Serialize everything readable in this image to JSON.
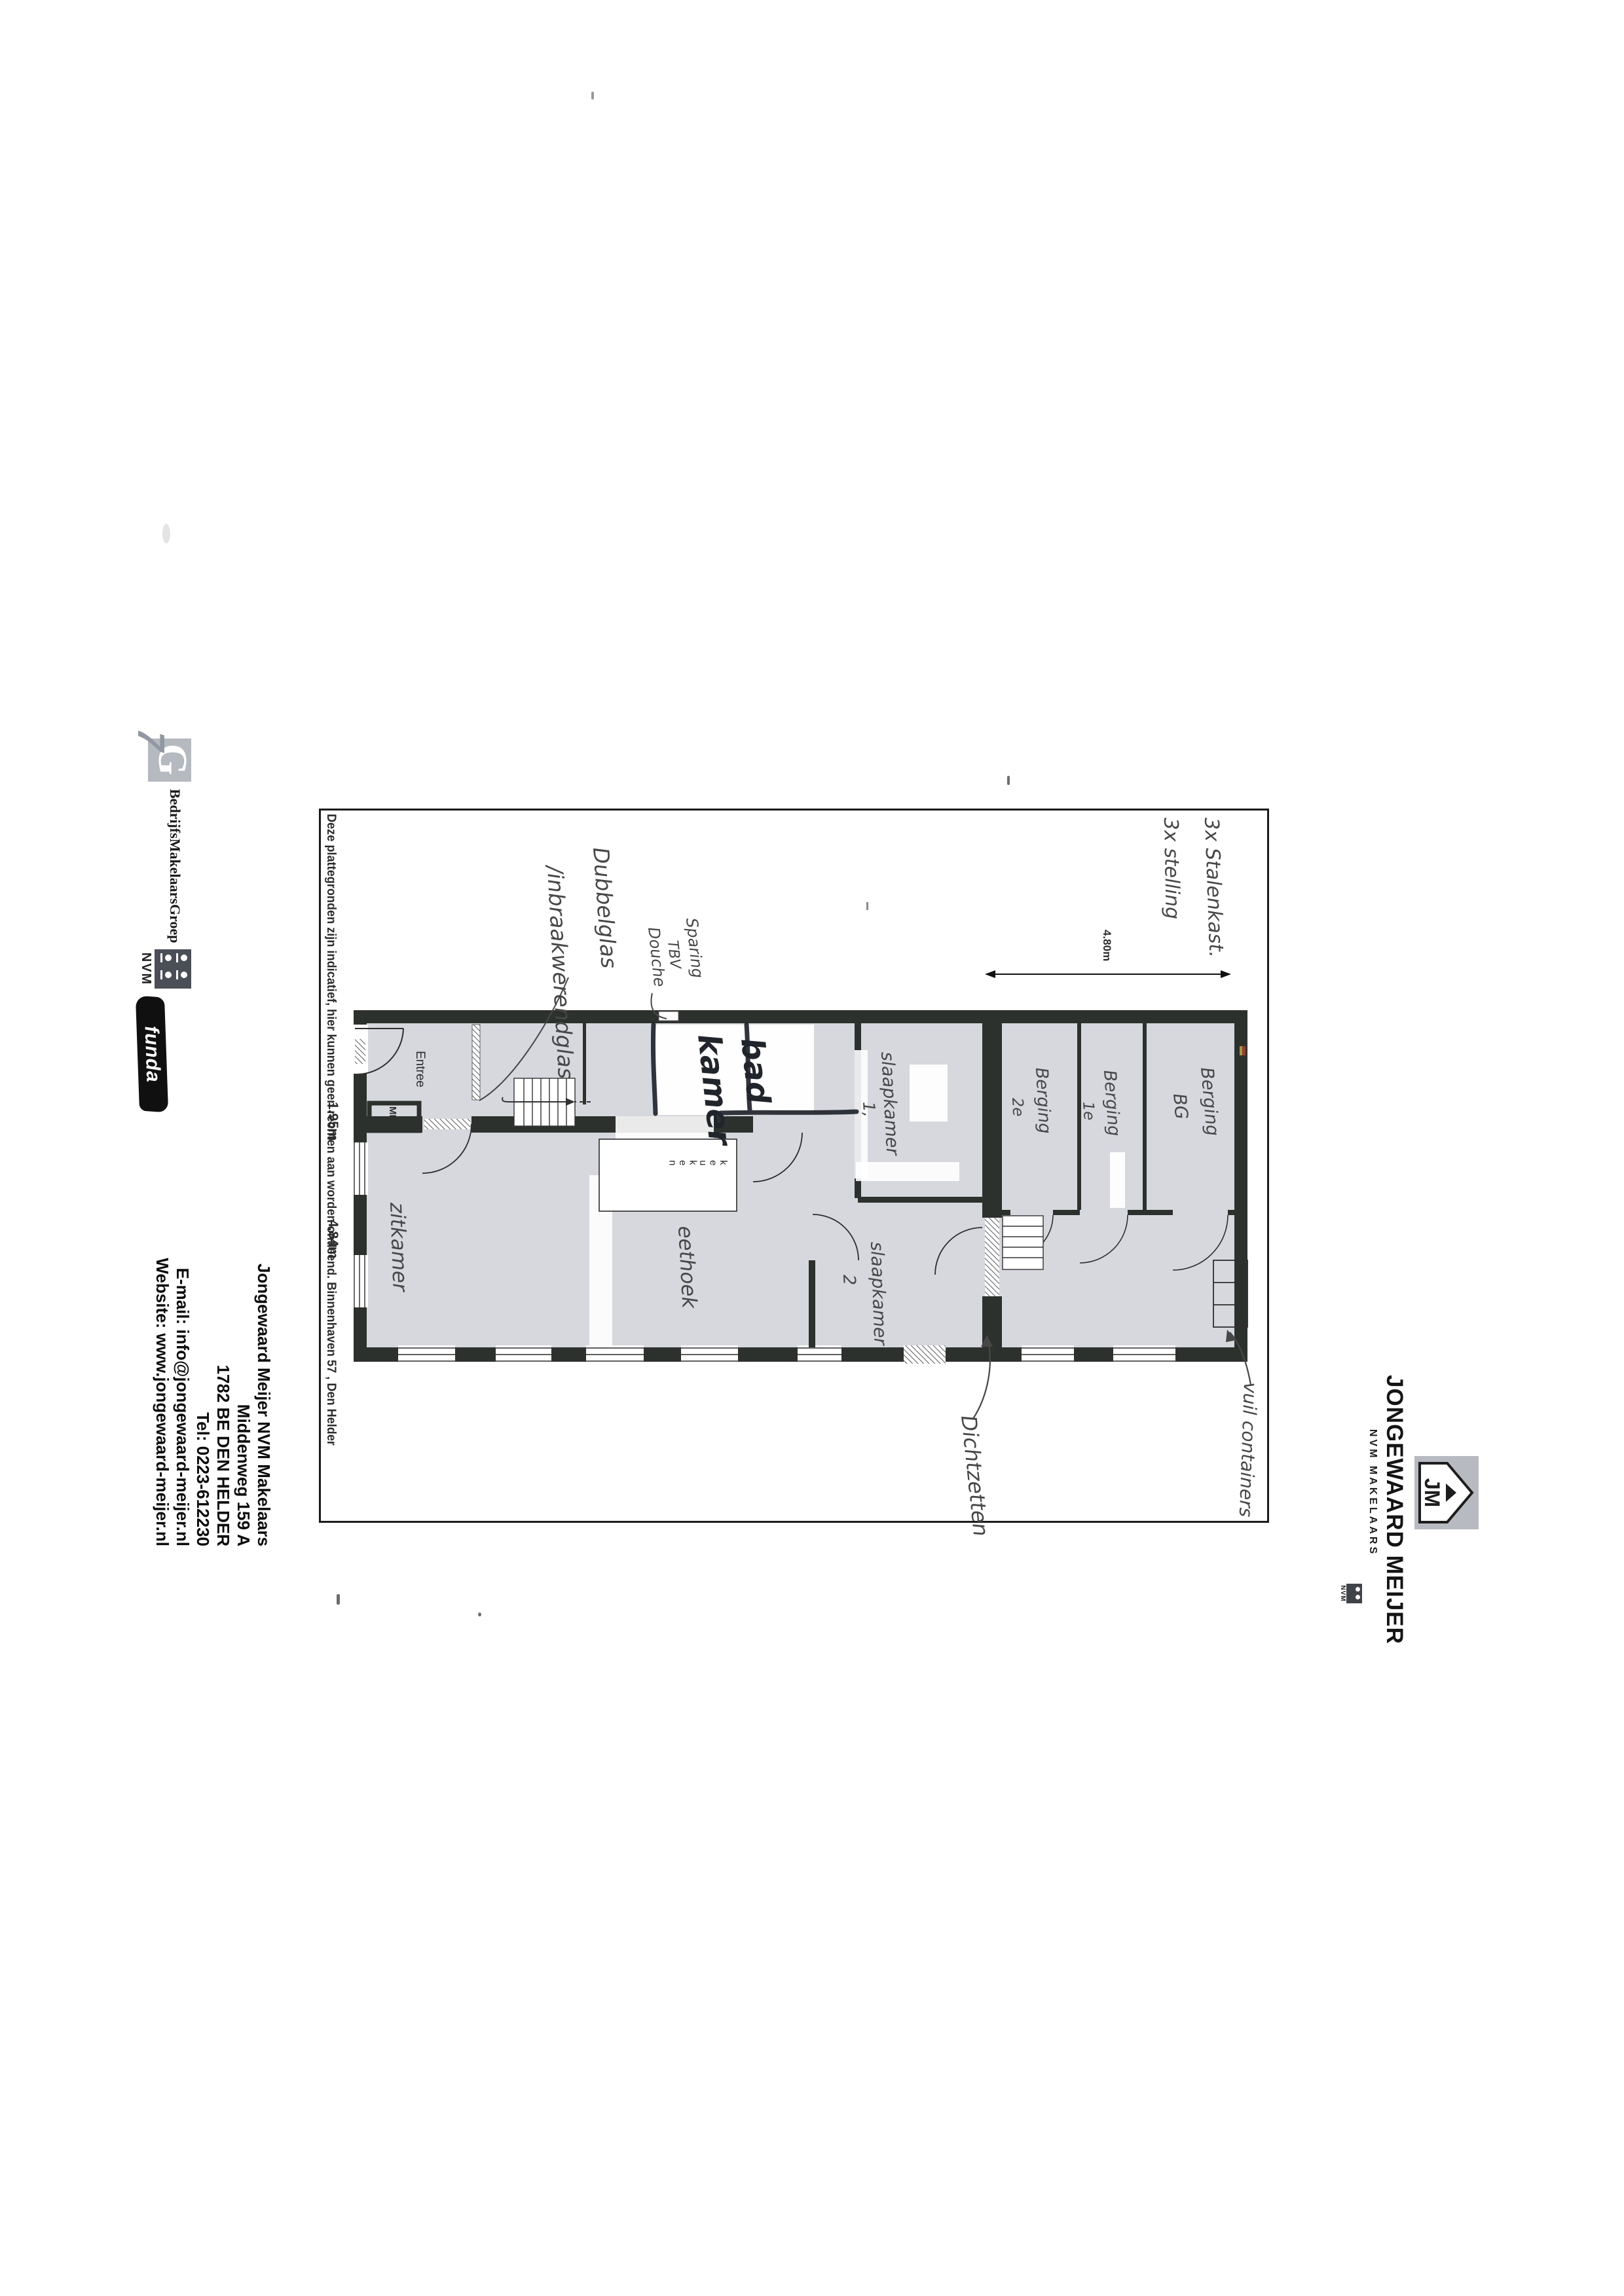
{
  "plan": {
    "disclaimer": "Deze plattegronden zijn indicatief, hier kunnen geen rechten aan worden ontleend.  Binnenhaven 57 , Den Helder",
    "dimensions": {
      "depth": "4.80m",
      "dim_a": "1.95m",
      "dim_b": "4.84m"
    },
    "rooms": {
      "entree": "Entree",
      "mk": "MK",
      "keuken": "keuken",
      "zitkamer": "zitkamer",
      "eethoek": "eethoek",
      "badkamer_line1": "bad",
      "badkamer_line2": "kamer",
      "slaapkamer1_line1": "slaapkamer",
      "slaapkamer1_line2": "1,",
      "slaapkamer2_line1": "slaapkamer",
      "slaapkamer2_line2": "2",
      "berging_bg_line1": "Berging",
      "berging_bg_line2": "BG",
      "berging_1e_line1": "Berging",
      "berging_1e_line2": "1e",
      "berging_2e_line1": "Berging",
      "berging_2e_line2": "2e"
    },
    "annotations": {
      "stalenkast": "3x Stalenkast.",
      "stelling": "3x stelling",
      "dubbelglas_line1": "Dubbelglas",
      "dubbelglas_line2": "/inbraakwerendglas",
      "sparing_line1": "Sparing",
      "sparing_line2": "TBV",
      "sparing_line3": "Douche",
      "dichtzetten": "Dichtzetten",
      "vuilcontainers": "vuil containers"
    }
  },
  "letterhead": {
    "brand": {
      "monogram": "JM",
      "title": "JONGEWAARD MEIJER",
      "subtitle": "NVM MAKELAARS",
      "nvm_small": "NVM"
    },
    "partners": {
      "g7_g": "G",
      "g7_seven": "7",
      "bmg": "BedrijfsMakelaarsGroep",
      "nvm": "NVM",
      "funda": "funda"
    },
    "address": {
      "line1": "Jongewaard Meijer NVM Makelaars",
      "line2": "Middenweg 159 A",
      "line3": "1782 BE DEN HELDER",
      "line4": "Tel: 0223-612230",
      "line5": "E-mail: info@jongewaard-meijer.nl",
      "line6": "Website: www.jongewaard-meijer.nl"
    }
  },
  "colors": {
    "wall": "#2d312d",
    "floor": "#d6d8de",
    "frame": "#1b1b1b",
    "handwriting": "#474747",
    "marker_ink": "#20242b",
    "logo_gray": "#b7bac1"
  }
}
